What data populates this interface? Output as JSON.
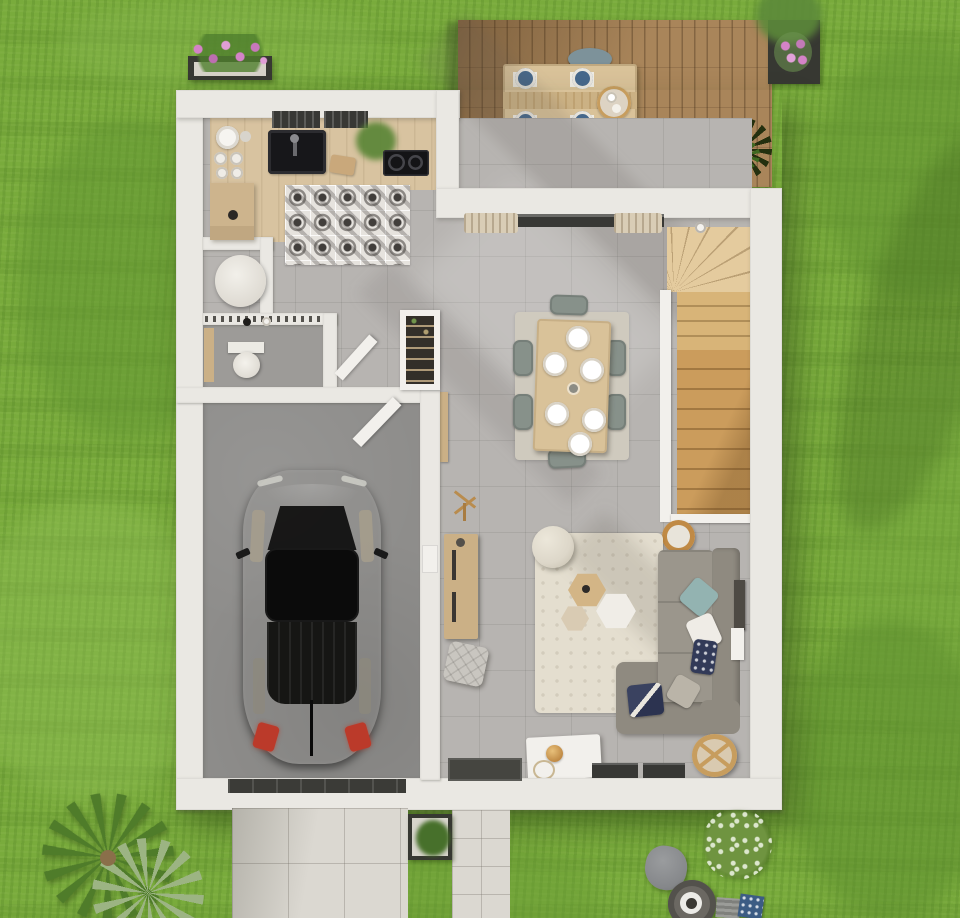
{
  "canvas": {
    "width": 960,
    "height": 918
  },
  "palette": {
    "grass": "#79ab3c",
    "grassDark": "#5f9230",
    "grassLight": "#96c25a",
    "deckWood": "#a9855a",
    "wall": "#eae8e3",
    "wallShade": "#d4d1ca",
    "concrete": "#b7b4b1",
    "bathFloor": "#9d9b98",
    "garageFloor": "#8e8d8b",
    "kitchenWood": "#d8c3a0",
    "islandWood": "#cdb48d",
    "counterWood": "#cbb086",
    "stairsUpper": "#e4cb9e",
    "stairsMid": "#d8b478",
    "stairsLower": "#cb9c5c",
    "rugDining": "#cfcabe",
    "rugLiving": "#e4decf",
    "tableWood": "#d9c299",
    "chairSage": "#87918a",
    "deckChair": "#7d929a",
    "sofa": "#8f8a80",
    "sofaLight": "#9b968c",
    "pillowTeal": "#93b3b1",
    "pillowNavy": "#323a58",
    "pillowWhite": "#efece6",
    "pillowGray": "#bab4a8",
    "carBody": "#222221",
    "carGlass": "#0d0d0d",
    "carWindow": "#a89f8c",
    "taillight": "#bb3a2a",
    "tileDark": "#413e3b",
    "tileBg": "#e6e3de",
    "driveTile": "#dbd8d1",
    "planterDark": "#373832",
    "foliage": "#4f7f2d",
    "flowerPink": "#d483c7",
    "poufCream": "#ddd7c9",
    "hexWood": "#d3b586",
    "hexWhite": "#f0ede7",
    "hexTan": "#d9cbb3",
    "lampRing": "#c08a45",
    "wicker": "#c79d5e",
    "tvDark": "#4e4a44",
    "glazingDark": "#383835",
    "curtain": "#d9cdb6",
    "doorDark": "#454540",
    "palmGreen": "#4f7c2a",
    "palmLight": "#9cb483",
    "oliveGreen": "#6f9440",
    "stoneGray": "#85878a",
    "potDark": "#53514c",
    "white": "#f2f0ec"
  },
  "scene": {
    "type": "3d-floor-plan-top-view",
    "exterior": [
      "lawn",
      "wood-terrace",
      "terrace-dining-set",
      "flower-box",
      "potted-flowers",
      "terrace-grass-plant",
      "driveway",
      "front-walkway",
      "south-planter-box",
      "palm-tree",
      "olive-bush",
      "stone-beanbag",
      "round-planter",
      "outdoor-mats"
    ],
    "rooms": [
      "kitchen",
      "wc",
      "bathroom",
      "hallway",
      "garage",
      "living-dining-room",
      "staircase"
    ],
    "kitchen_items": [
      "counter",
      "sink",
      "cooktop",
      "dish-stack",
      "cutting-board",
      "house-plant",
      "island-cabinet",
      "patterned-tile-rug",
      "wall-windows"
    ],
    "bathroom_items": [
      "toilet",
      "vanity",
      "shower-rail"
    ],
    "wc_items": [
      "round-fixture"
    ],
    "garage_items": [
      "car",
      "garage-door",
      "swing-door"
    ],
    "living_items": [
      "dining-table",
      "six-chairs",
      "dining-rug",
      "sliding-bay-curtains",
      "corner-sofa",
      "cushions",
      "living-rug",
      "hex-side-tables",
      "floor-lamp",
      "pouf",
      "tv-panel",
      "white-cabinet",
      "wicker-chair",
      "bay-windows",
      "front-door",
      "sideboard",
      "coat-rack",
      "quilted-pouf",
      "pantry-shelf"
    ]
  }
}
